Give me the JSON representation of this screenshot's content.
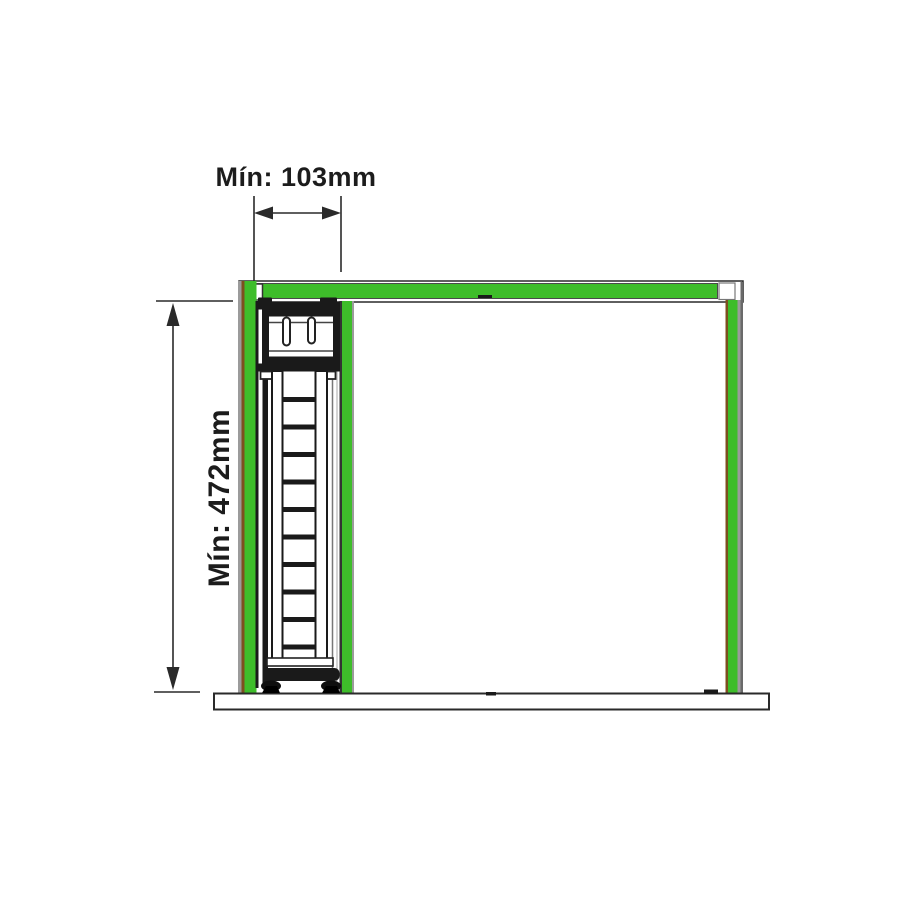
{
  "labels": {
    "width_min": "Mín: 103mm",
    "height_min": "Mín: 472mm"
  },
  "colors": {
    "background": "#ffffff",
    "panel_green": "#3ebd2a",
    "panel_edge_brown": "#7d4f1f",
    "panel_edge_grey": "#9b9b9b",
    "line_dark": "#2a2a2a",
    "unit_dark": "#1a1a1a",
    "text": "#1c1c1c"
  },
  "diagram": {
    "ladder": {
      "rung_count": 10,
      "x": 282.5,
      "width": 33,
      "height": 5,
      "first_y": 397,
      "spacing": 27.5
    }
  }
}
